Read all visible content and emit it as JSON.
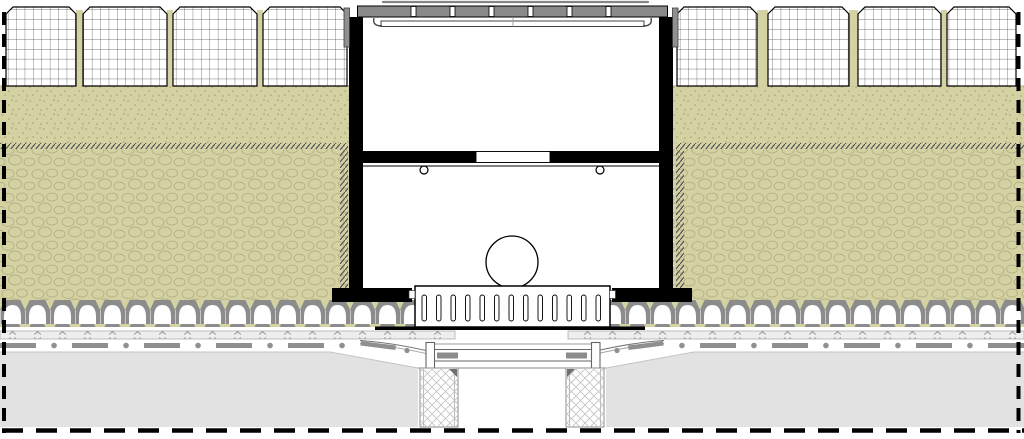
{
  "drawing": {
    "kind": "technical-cross-section",
    "subject": "drainage-channel-installation-detail",
    "canvas": {
      "width": 1024,
      "height": 439,
      "background": "#ffffff"
    }
  },
  "colors": {
    "black": "#000000",
    "white": "#ffffff",
    "grate_gray": "#8a8a8a",
    "steel_gray": "#909090",
    "soil_olive": "#d4d1a2",
    "cobble_line": "#b5b187",
    "speckle_dot": "#a09c72",
    "hatch_dark": "#4a4a55",
    "crown_gray": "#8c8c8c",
    "membrane_fill": "#eeeeee",
    "membrane_mark": "#9a9a9a",
    "dashdot_gray": "#8f8f8f",
    "concrete_gray": "#e2e2e2",
    "outline_dark": "#3a3a3a",
    "line_mid": "#777777",
    "lattice_line": "#c2c2c2"
  },
  "counts": {
    "paver_blocks": 8,
    "grate_slots": 6,
    "base_element_slots": 13,
    "divider_handles": 2,
    "lattice_columns": 2
  }
}
